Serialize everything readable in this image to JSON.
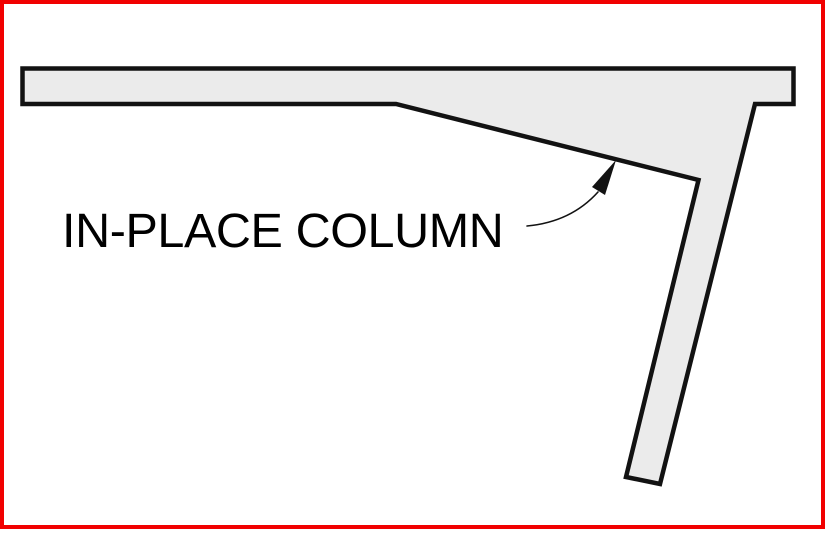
{
  "drawing": {
    "label": "IN-PLACE COLUMN",
    "subject": "haunched-slab-with-inclined-cast-in-place-column-section"
  },
  "colors": {
    "frame_border": "#f10000",
    "shape_fill": "#ebebeb",
    "line": "#121212",
    "text": "#000000",
    "background": "#ffffff"
  }
}
